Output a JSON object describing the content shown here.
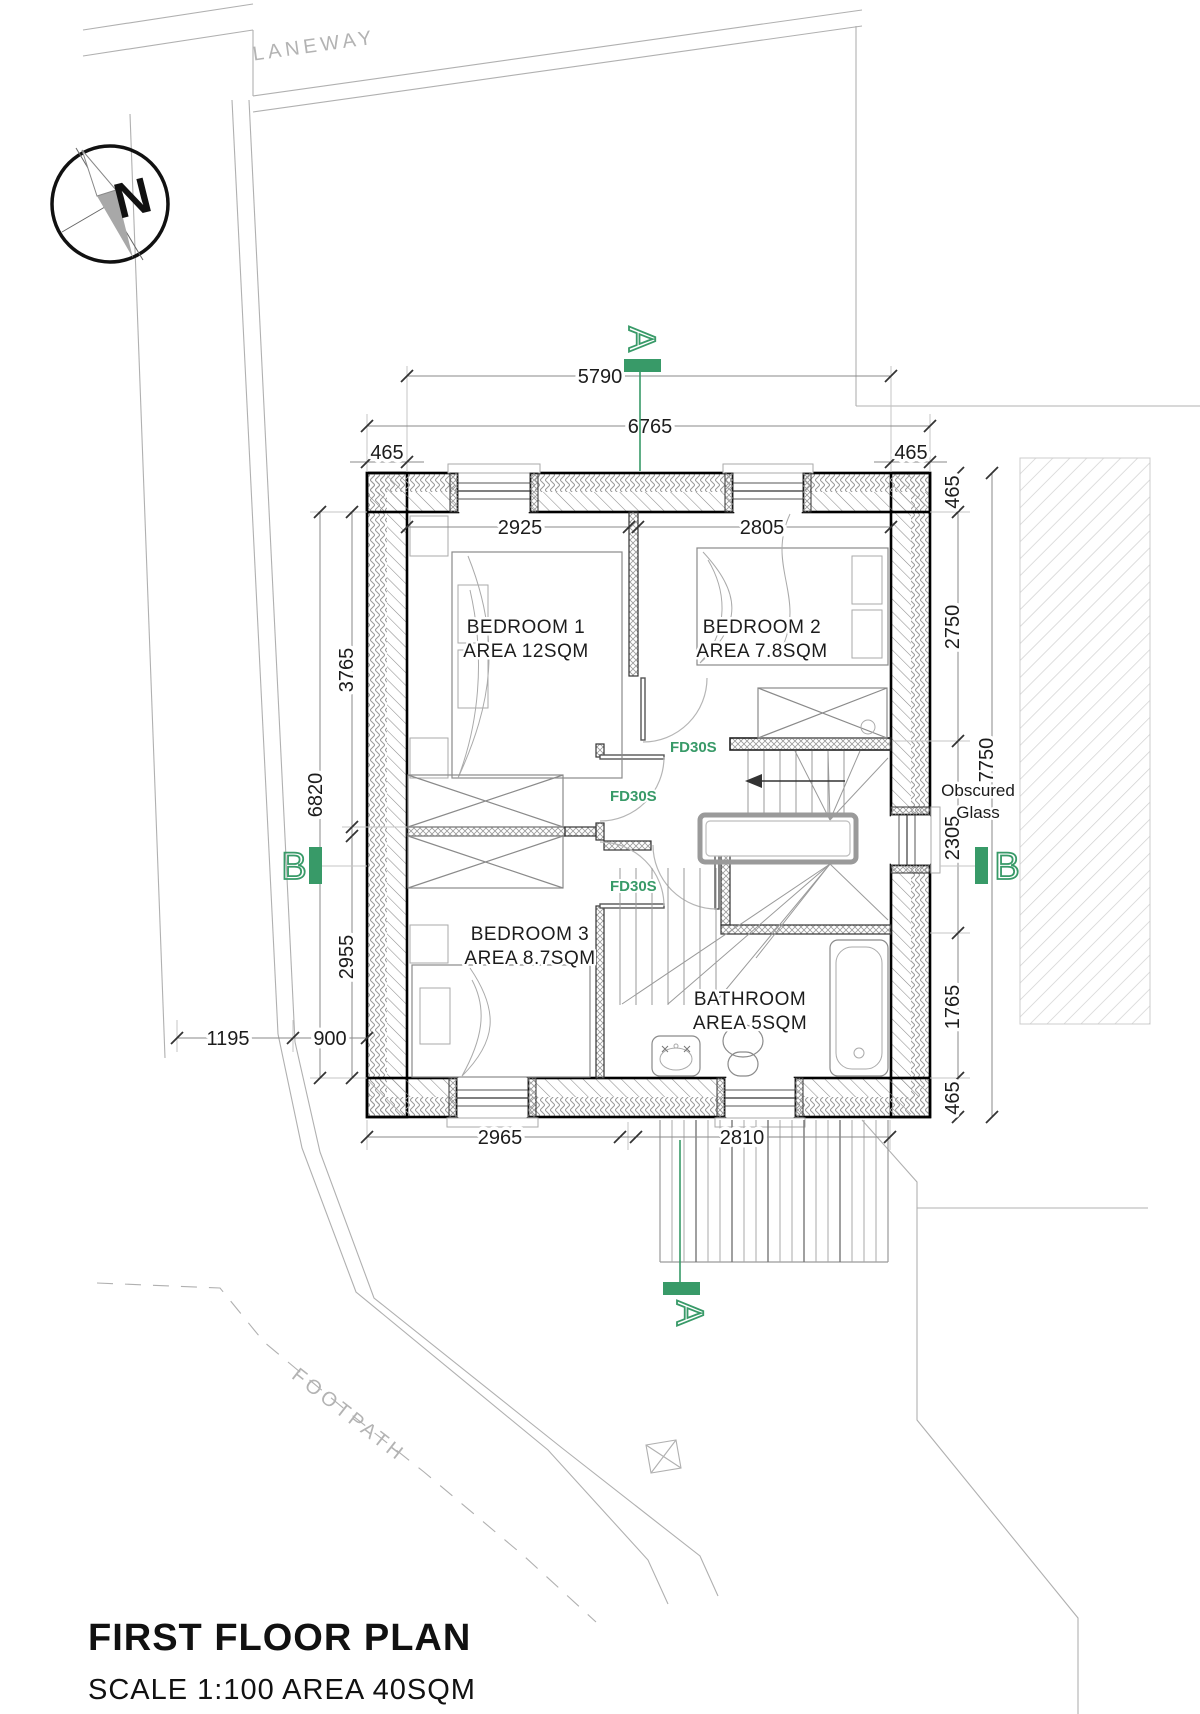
{
  "colors": {
    "accent_green": "#389a68",
    "line_gray": "#8a8a8a",
    "boundary_gray": "#b0b0b0",
    "wall_black": "#000000"
  },
  "site": {
    "laneway": "LANEWAY",
    "footpath": "FOOTPATH",
    "north": "N"
  },
  "titleblock": {
    "title": "FIRST FLOOR PLAN",
    "subtitle": "SCALE 1:100  AREA 40SQM"
  },
  "rooms": {
    "b1name": "BEDROOM 1",
    "b1area": "AREA 12SQM",
    "b2name": "BEDROOM 2",
    "b2area": "AREA 7.8SQM",
    "b3name": "BEDROOM 3",
    "b3area": "AREA 8.7SQM",
    "bathname": "BATHROOM",
    "batharea": "AREA 5SQM"
  },
  "labels": {
    "fire_door": "FD30S",
    "obscured_line1": "Obscured",
    "obscured_line2": "Glass"
  },
  "sections": {
    "a": "A",
    "b": "B"
  },
  "dims": {
    "d5790": "5790",
    "d6765": "6765",
    "d465": "465",
    "d2925": "2925",
    "d2805": "2805",
    "d3765": "3765",
    "d6820": "6820",
    "d2955": "2955",
    "d900": "900",
    "d1195": "1195",
    "d2750": "2750",
    "d7750": "7750",
    "d2305": "2305",
    "d1765": "1765",
    "d2965": "2965",
    "d2810": "2810"
  }
}
